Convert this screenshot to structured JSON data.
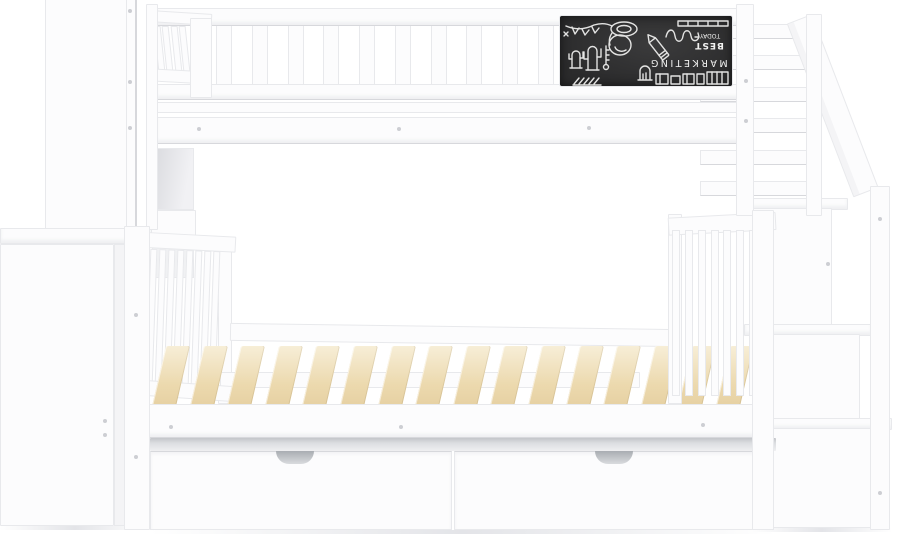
{
  "meta": {
    "description": "Product photo: white twin-over-full bunk bed with storage staircase, hanging chalkboard panel, wooden mattress slats, two under-bed storage drawers and a side shelf tower on a white background"
  },
  "product": {
    "frame_color_name": "White",
    "slat_material_name": "Natural wood",
    "colors": {
      "frame": "#fcfcfd",
      "frame_shade": "#f4f4f6",
      "edge": "#e8e9ec",
      "edge_dark": "#d7d8dc",
      "recess": "#c3c5c9",
      "wood": "#ecd9ae",
      "wood_light": "#f7eed7",
      "wood_dark": "#dfc795",
      "chalkboard": "#2b2b2c",
      "chalk": "#f2f2f1",
      "dot": "#cdced3",
      "shadow": "#e3e4e8"
    }
  },
  "chalkboard": {
    "orientation": "upside-down",
    "texts": {
      "word1": "MARKETING",
      "word2": "BEST",
      "word3": "TODAY"
    },
    "doodles": [
      "bunting-garland",
      "cactus",
      "cactus",
      "thermometer",
      "megaphone-bell",
      "grave-marker",
      "pencil",
      "squiggle-line",
      "ruler-bar",
      "book-row",
      "hatch-band"
    ]
  },
  "counts": {
    "guardrail_slats": 10,
    "headboard_mini_slats": 4,
    "lower_headboard_spindles": 8,
    "footboard_spindles": 8,
    "stair_rail_bars": 6,
    "mattress_slats": 16,
    "drawers": 2,
    "stair_steps": 3
  }
}
